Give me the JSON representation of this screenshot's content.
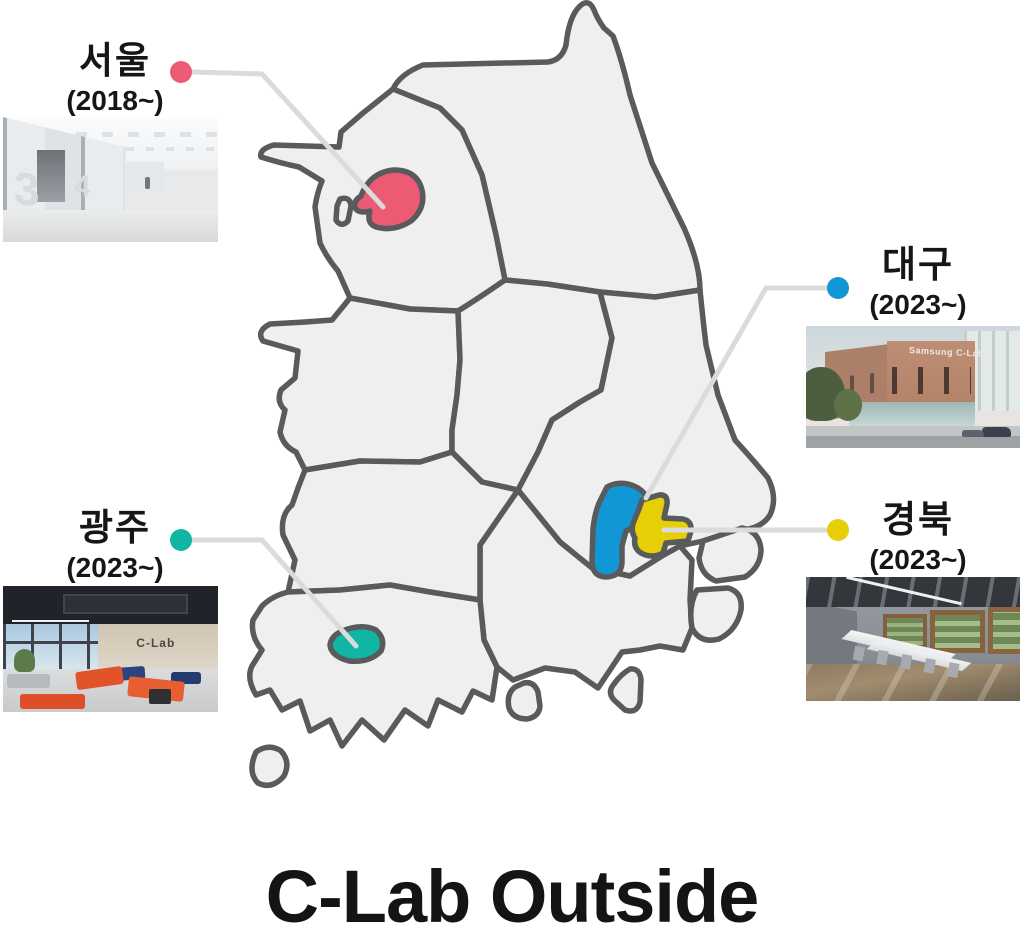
{
  "title": "C-Lab Outside",
  "map": {
    "land_fill": "#F0EFEF",
    "border_stroke": "#595A5C",
    "connector_color": "#DBDBDB"
  },
  "locations": [
    {
      "id": "seoul",
      "name": "서울",
      "since": "(2018~)",
      "color": "#ED5A74",
      "photo_marks": [
        "3",
        "4"
      ]
    },
    {
      "id": "daegu",
      "name": "대구",
      "since": "(2023~)",
      "color": "#1197D6",
      "photo_sign": "Samsung C-Lab"
    },
    {
      "id": "gyeongbuk",
      "name": "경북",
      "since": "(2023~)",
      "color": "#E6CF07"
    },
    {
      "id": "gwangju",
      "name": "광주",
      "since": "(2023~)",
      "color": "#10B5A3",
      "photo_sign": "C-Lab"
    }
  ]
}
